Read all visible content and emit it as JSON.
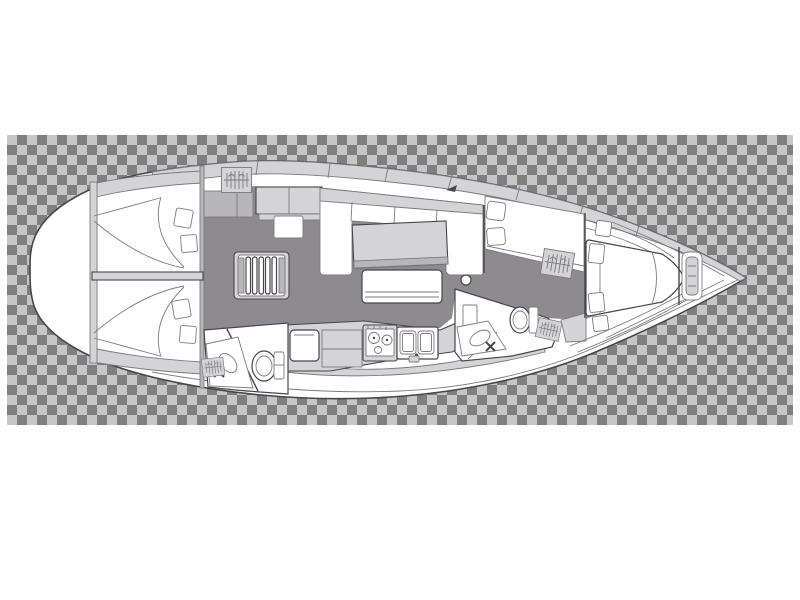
{
  "title": "Sailing yacht interior layout floor plan (top view, bow to the right)",
  "background": {
    "style": "transparency-checkerboard",
    "tile_px": 10,
    "area": {
      "x": 7,
      "y": 135,
      "width": 786,
      "height": 290
    }
  },
  "colors": {
    "canvas": "#ffffff",
    "checker-light": "#c6c6c6",
    "checker-dark": "#7f7f7f",
    "hull": "#ffffff",
    "outline": "#46464b",
    "line": "#7b7a7f",
    "sole": "#8d8b90",
    "furniture": "#d4d3d6",
    "panel": "#b7b6ba"
  },
  "vessel": {
    "orientation": "bow-right",
    "areas": {
      "hull": {
        "label": "Yacht hull outline"
      },
      "aft_cabin_port": {
        "label": "Aft double cabin with bed and pillows (top)"
      },
      "aft_cabin_starboard": {
        "label": "Aft double cabin with bed and pillows (bottom)"
      },
      "companionway": {
        "label": "Companionway steps"
      },
      "aft_head": {
        "label": "Aft heads with toilet and wash basin"
      },
      "salon": {
        "label": "Salon with U-shaped settee, table and bench"
      },
      "galley": {
        "label": "Galley with fridge, two-burner stove and double sink"
      },
      "nav_seat": {
        "label": "Forward seat / chart area with cushions"
      },
      "forward_head": {
        "label": "Forward heads with toilet and wash basin"
      },
      "hanging_locker": {
        "label": "Hanging locker (wardrobe)"
      },
      "forward_cabin": {
        "label": "Forward double cabin with island berth"
      },
      "anchor_locker": {
        "label": "Bow anchor locker"
      },
      "mast_post": {
        "label": "Mast post"
      }
    }
  }
}
